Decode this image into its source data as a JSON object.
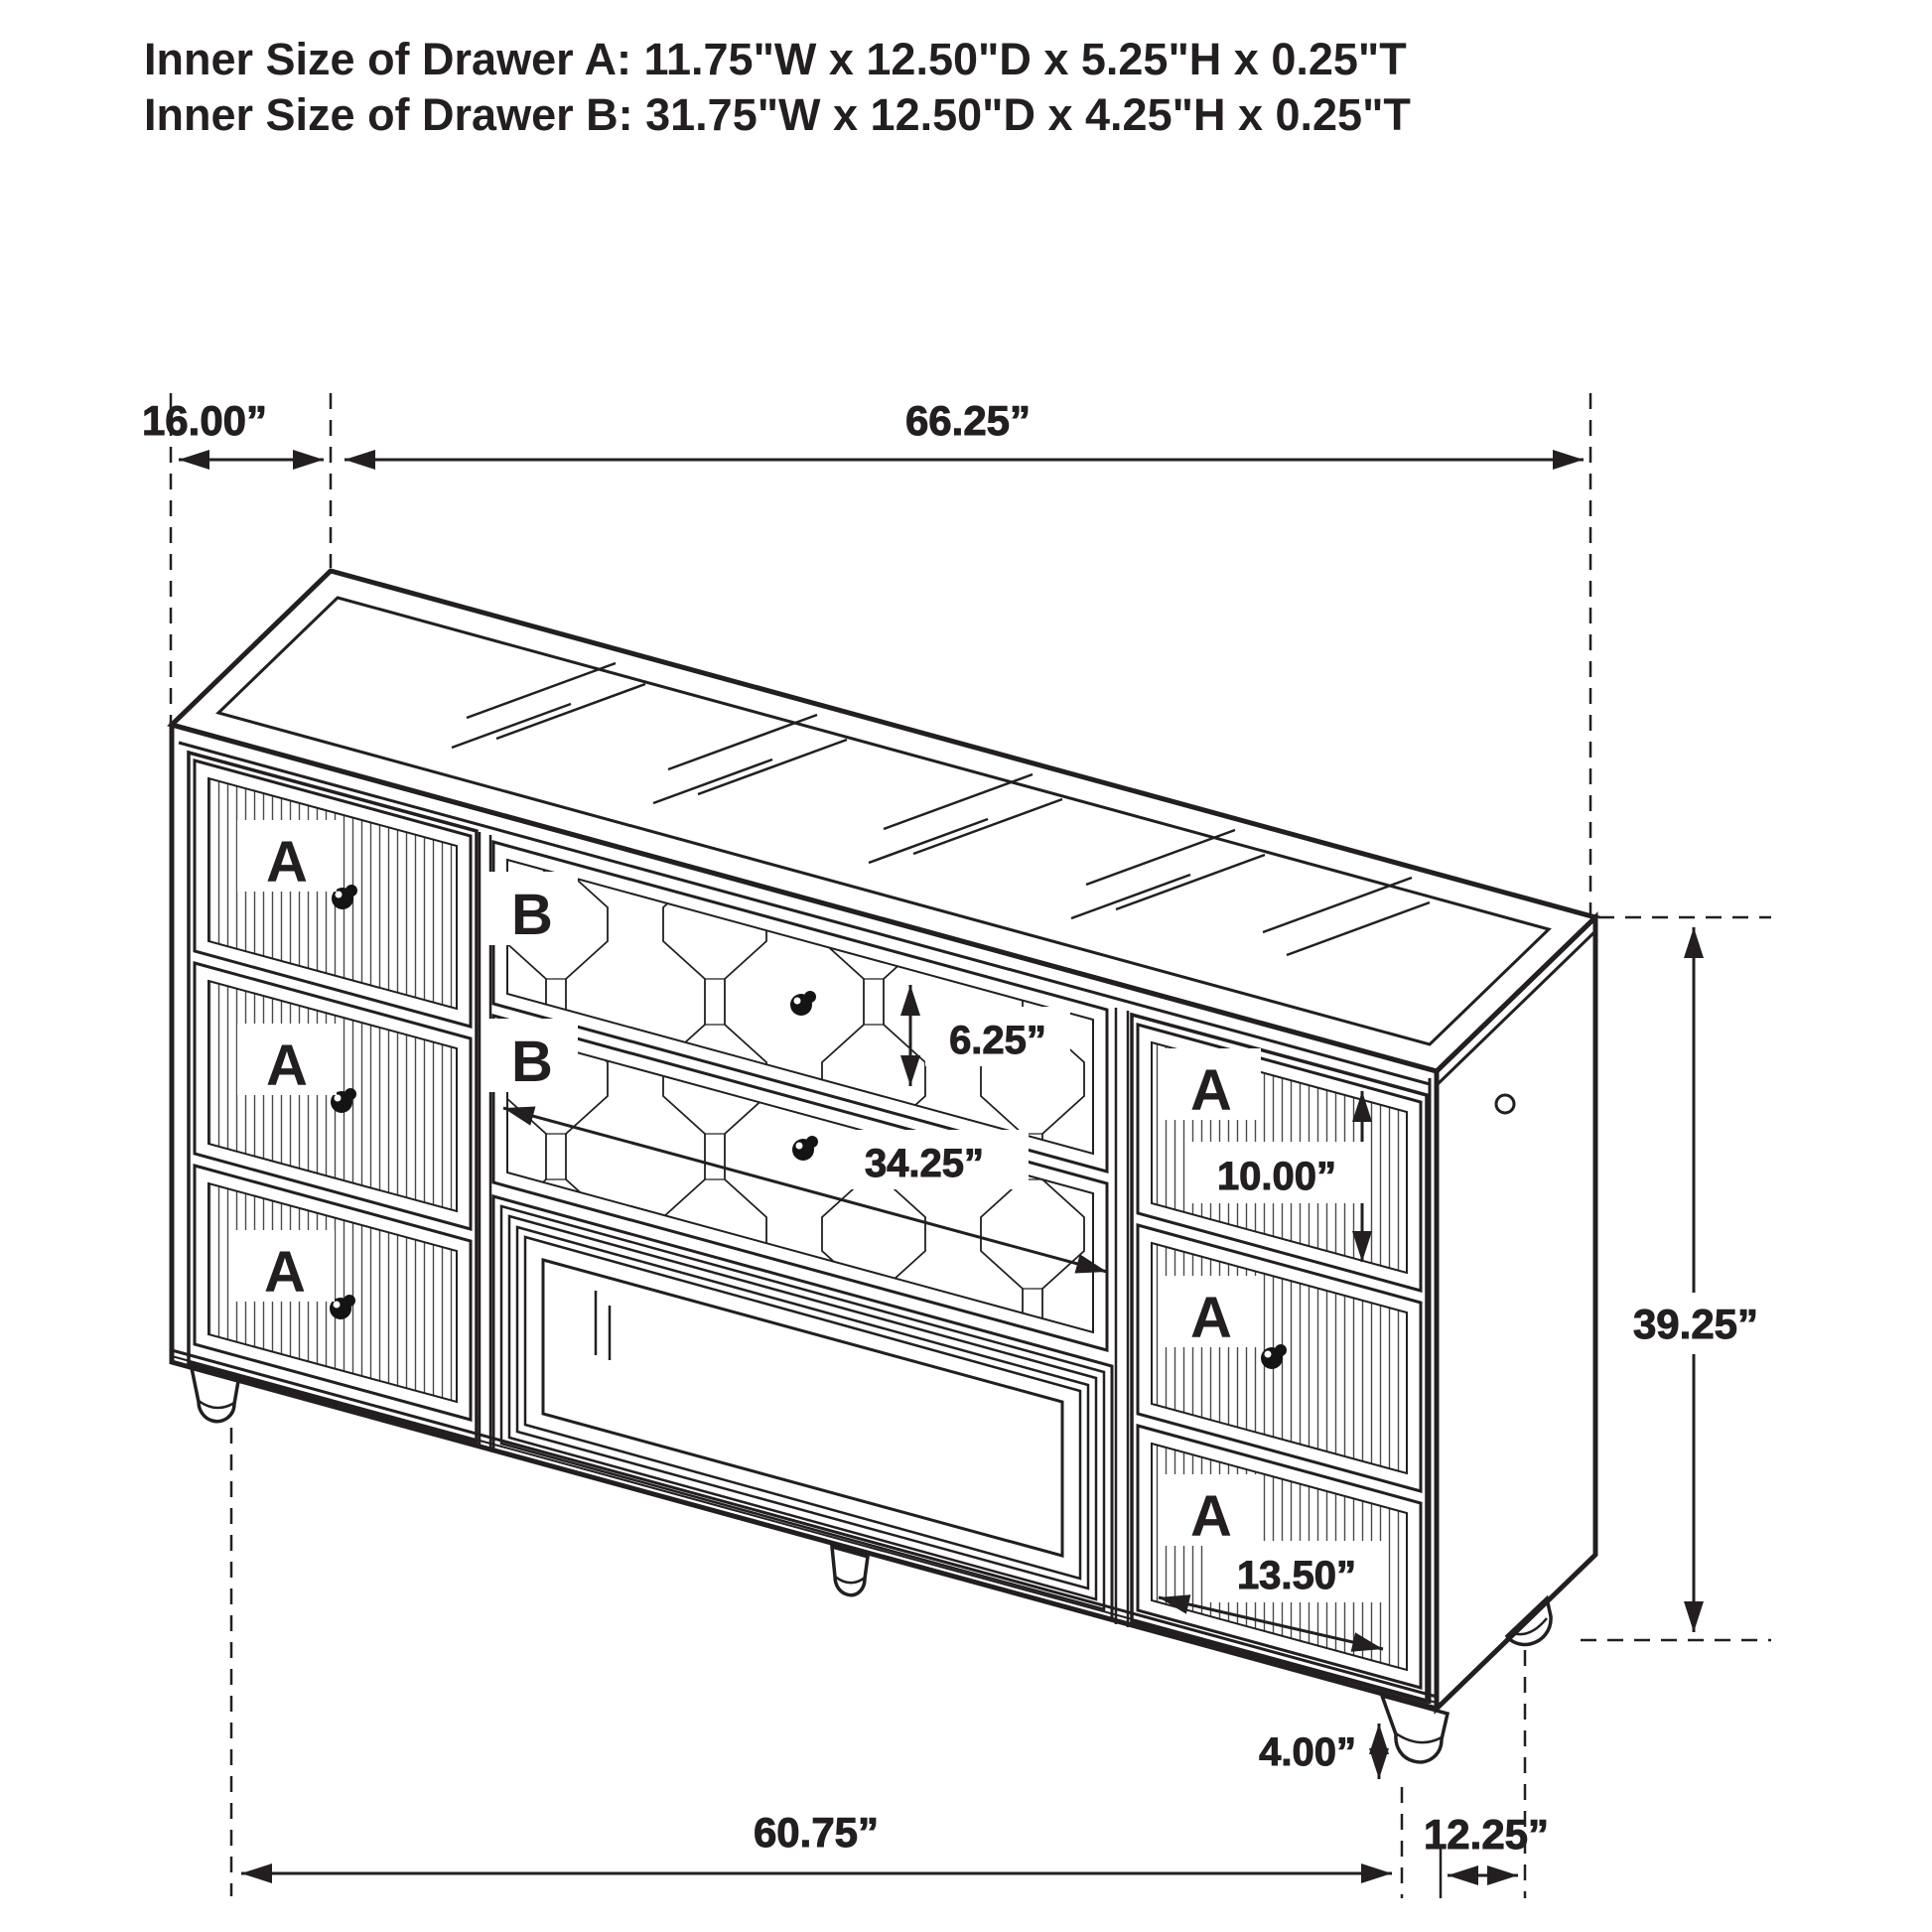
{
  "title": {
    "line1": "Inner Size of Drawer A: 11.75\"W x 12.50\"D x 5.25\"H x 0.25\"T",
    "line2": "Inner Size of Drawer B: 31.75\"W x 12.50\"D x 4.25\"H x 0.25\"T"
  },
  "drawer_labels": {
    "a": "A",
    "b": "B"
  },
  "dimensions": {
    "top_depth": "16.00”",
    "top_width": "66.25”",
    "b_drawer_height": "6.25”",
    "b_drawer_width": "34.25”",
    "right_top_drawer_height": "10.00”",
    "overall_height": "39.25”",
    "right_bottom_drawer_width": "13.50”",
    "leg_height": "4.00”",
    "bottom_width": "60.75”",
    "bottom_depth": "12.25”"
  },
  "colors": {
    "line": "#231f20",
    "label_red": "#e8212a",
    "background": "#ffffff"
  }
}
